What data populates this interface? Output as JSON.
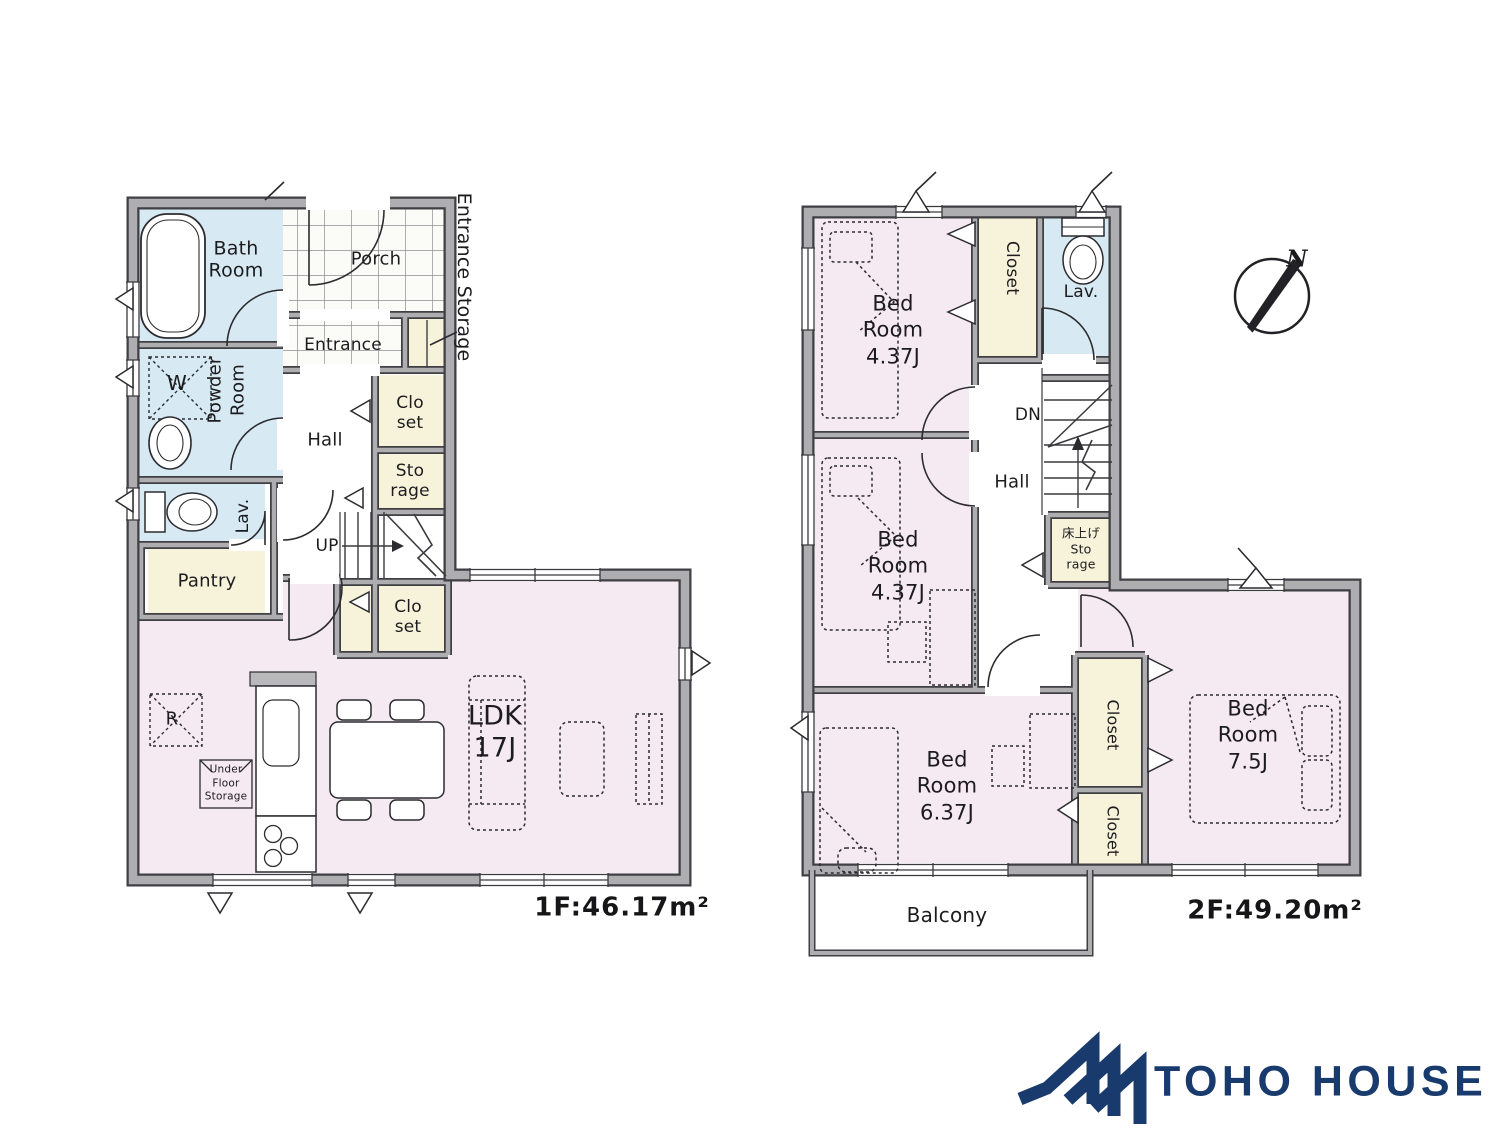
{
  "floor1": {
    "area_label": "1F:46.17m²",
    "rooms": {
      "bath": "Bath\nRoom",
      "porch": "Porch",
      "entrance_storage": "Entrance Storage",
      "entrance": "Entrance",
      "washer": "W",
      "powder": "Powder\nRoom",
      "hall": "Hall",
      "closet_upper": "Clo\nset",
      "storage": "Sto\nrage",
      "lav": "Lav.",
      "stairs_up": "UP",
      "pantry": "Pantry",
      "closet_lower": "Clo\nset",
      "fridge": "R",
      "under_floor_storage": "Under\nFloor\nStorage",
      "ldk": "LDK\n17J"
    }
  },
  "floor2": {
    "area_label": "2F:49.20m²",
    "compass_north": "N",
    "rooms": {
      "bed1": "Bed\nRoom\n4.37J",
      "closet_top": "Closet",
      "lav": "Lav.",
      "stairs_down": "DN",
      "hall": "Hall",
      "raised_storage": "床上げ\nSto\nrage",
      "bed2": "Bed\nRoom\n4.37J",
      "bed3": "Bed\nRoom\n6.37J",
      "closet_right_upper": "Closet",
      "closet_right_lower": "Closet",
      "bed4": "Bed\nRoom\n7.5J",
      "balcony": "Balcony"
    }
  },
  "brand": {
    "name": "TOHO HOUSE"
  },
  "colors": {
    "room_pink": "#f5e9f2",
    "wet_blue": "#d7e9f2",
    "closet_cream": "#f7f2da",
    "wall_gray": "#aeaeb0",
    "wall_edge": "#3f3f44",
    "brand_navy": "#183a6d"
  }
}
